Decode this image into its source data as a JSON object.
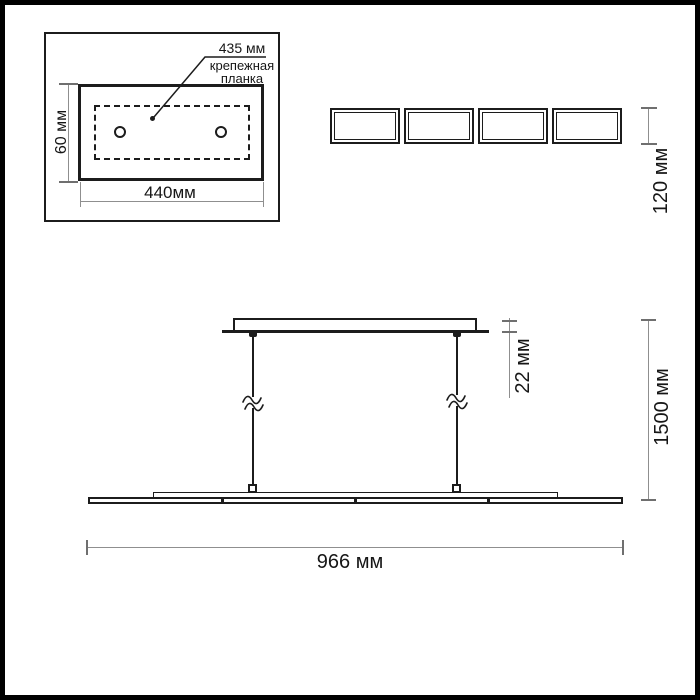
{
  "inset": {
    "callout": {
      "dimension": "435 мм",
      "target": "крепежная\nпланка"
    },
    "height_dim": "60 мм",
    "width_dim": "440мм"
  },
  "top_view": {
    "module_count": 4,
    "height_dim": "120 мм"
  },
  "side_view": {
    "canopy_height_dim": "22 мм",
    "suspension_length_dim": "1500 мм",
    "fixture_length_dim": "966 мм",
    "suspension_count": 2,
    "bar_segments": 4
  },
  "colors": {
    "line": "#1c1c1c",
    "dim_line": "#8f8f8f",
    "dim_tick": "#6f6f6f",
    "background": "#ffffff"
  }
}
